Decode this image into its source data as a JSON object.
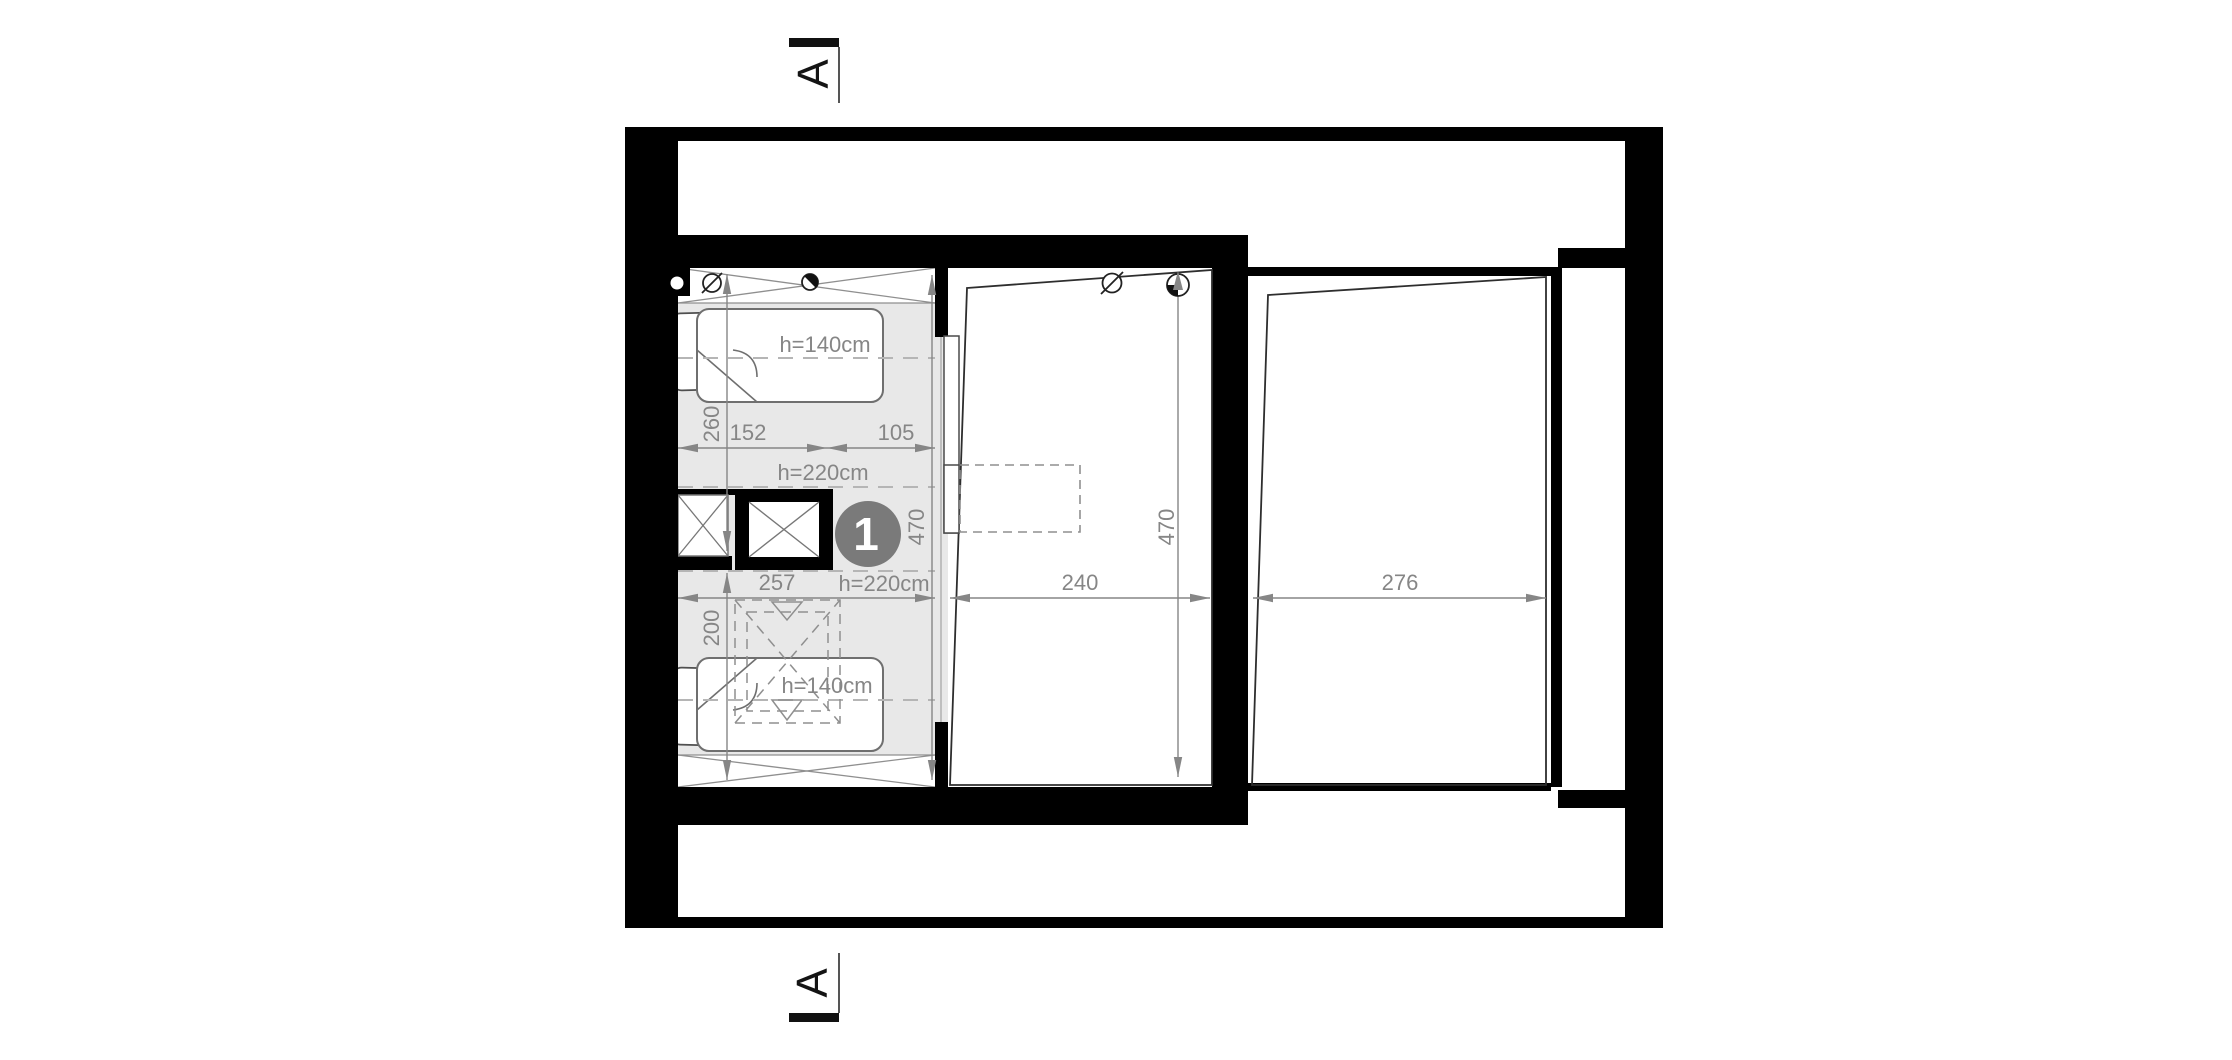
{
  "section_markers": {
    "top_label": "A",
    "bottom_label": "A"
  },
  "badge": {
    "number": "1",
    "color": "#7a7a7a"
  },
  "labels": {
    "bed_top_height": "h=140cm",
    "ceiling_top": "h=220cm",
    "ceiling_bottom": "h=220cm",
    "bed_bottom_height": "h=140cm"
  },
  "dimensions": {
    "left_vertical_upper": "260",
    "left_seg_a": "152",
    "left_seg_b": "105",
    "left_room_depth": "470",
    "left_width": "257",
    "left_vertical_lower": "200",
    "middle_width": "240",
    "middle_depth": "470",
    "right_width": "276"
  },
  "colors": {
    "wall": "#000000",
    "floor_shade": "#e8e8e8",
    "dimension_gray": "#868686",
    "dashed_gray": "#b5b5b5",
    "outline_dark": "#2e2e2e"
  }
}
